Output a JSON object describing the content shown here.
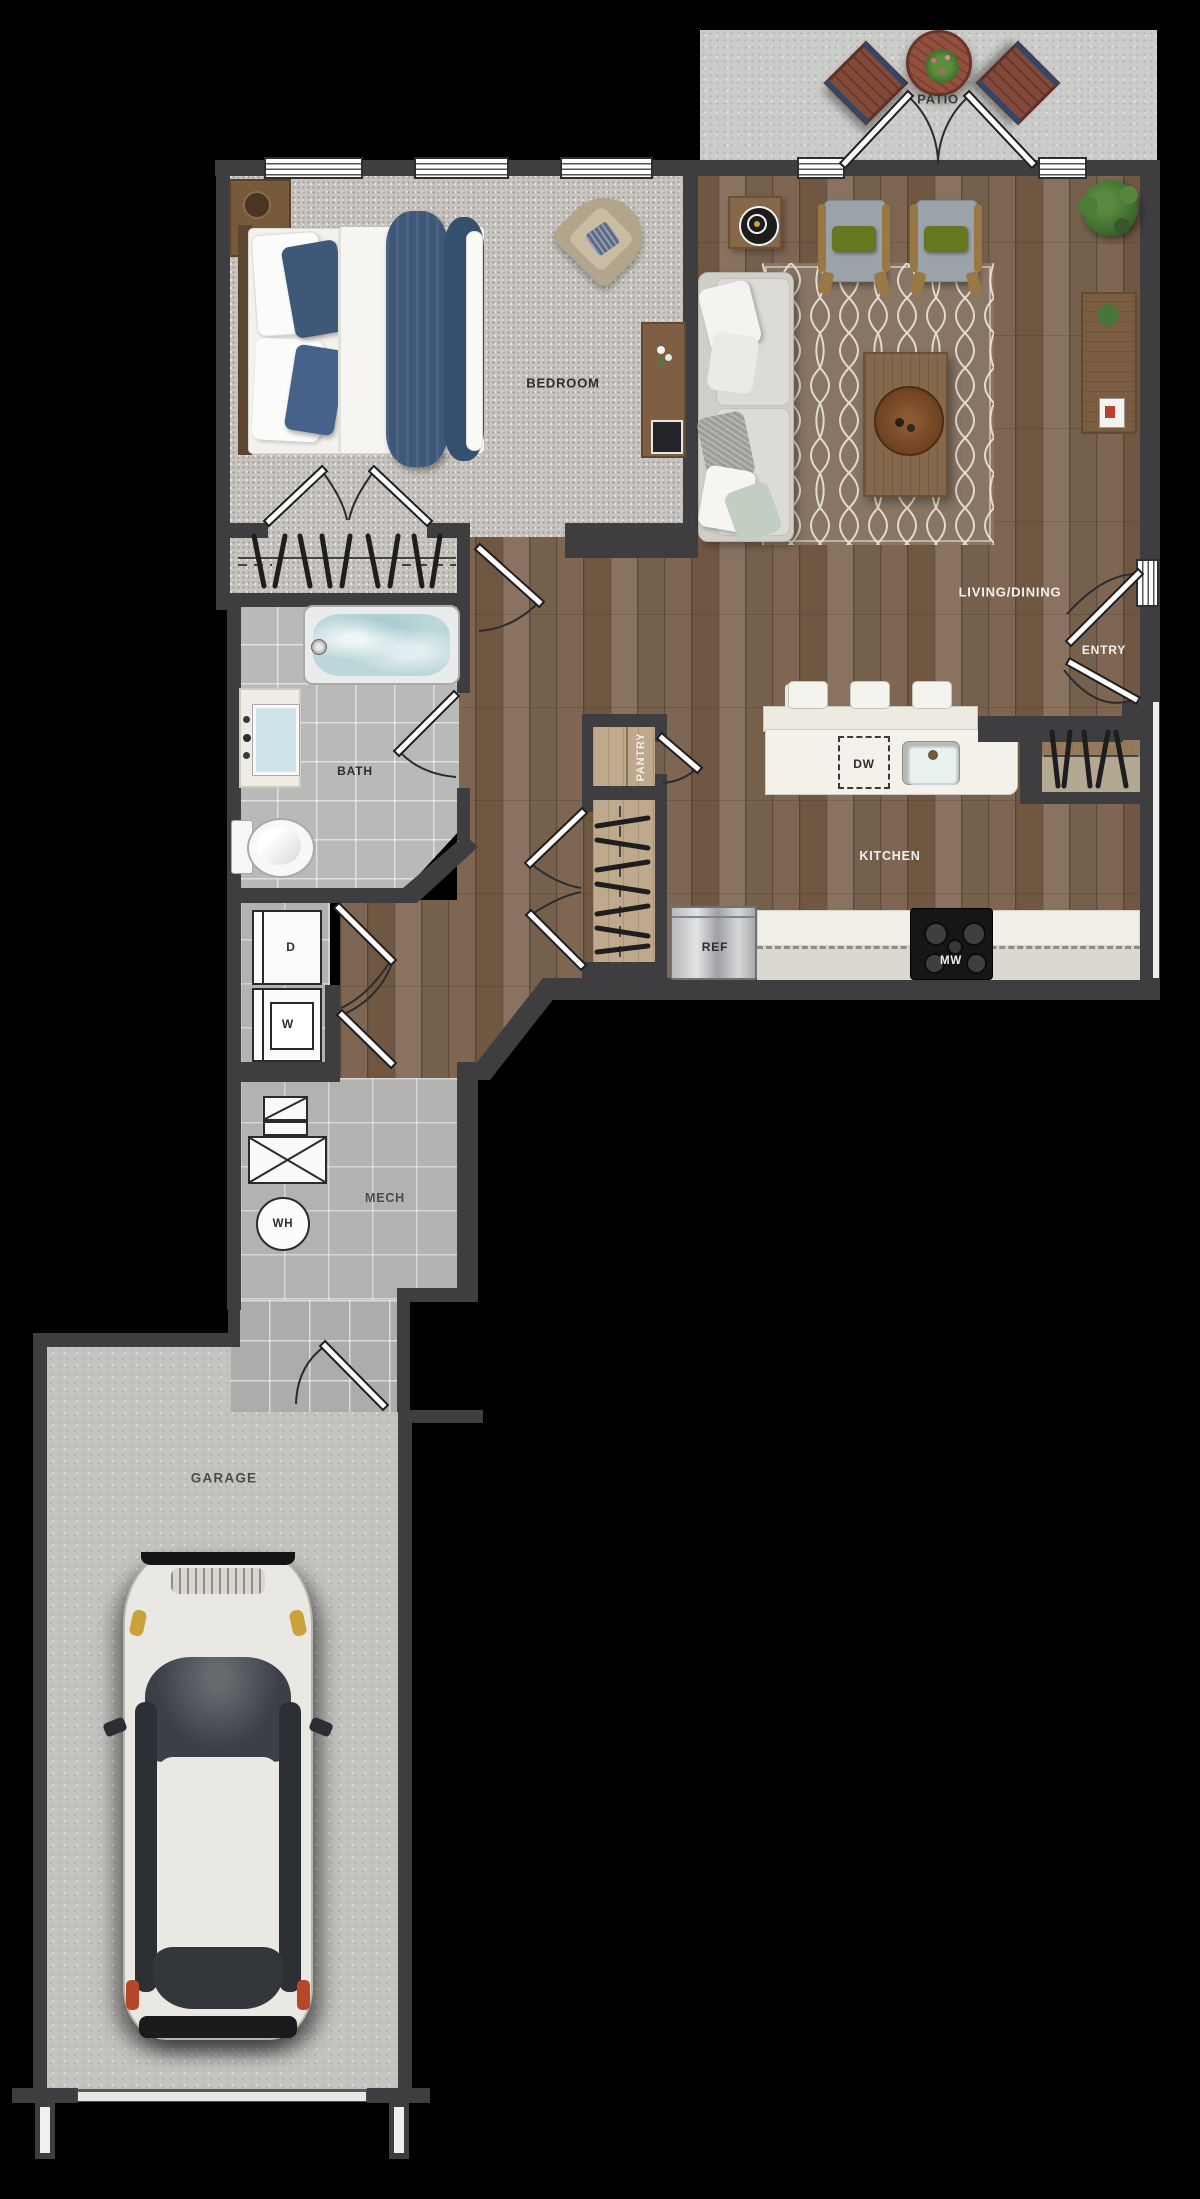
{
  "labels": {
    "patio": "PATIO",
    "bedroom": "BEDROOM",
    "living_dining": "LIVING/DINING",
    "entry": "ENTRY",
    "bath": "BATH",
    "pantry": "PANTRY",
    "kitchen": "KITCHEN",
    "mech": "MECH",
    "garage": "GARAGE",
    "dishwasher": "DW",
    "refrigerator": "REF",
    "microwave": "MW",
    "dryer": "D",
    "washer": "W",
    "water_heater": "WH"
  },
  "colors": {
    "background": "#000000",
    "walls": "#3e3e41",
    "wood_floor": "#79614d",
    "carpet": "#c8c5c0",
    "tile": "#b9b9b7",
    "concrete": "#cbcbc9",
    "counter": "#f2f0e9",
    "accent_navy": "#3e5878",
    "accent_green": "#66781f",
    "rug": "#8f7c69"
  }
}
